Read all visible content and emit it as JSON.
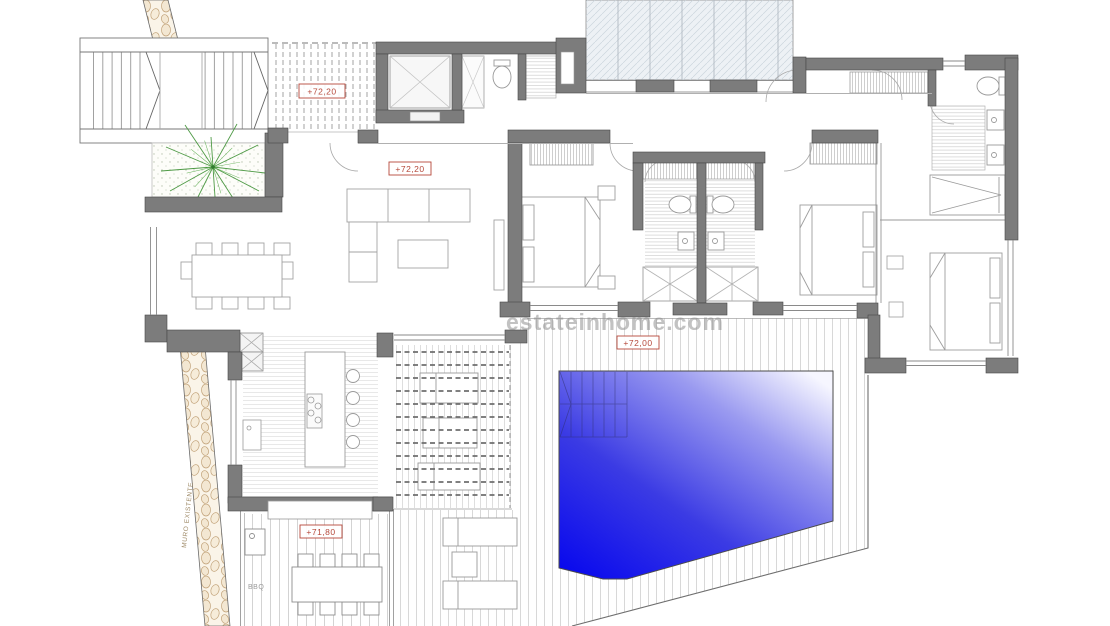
{
  "page": {
    "type": "architectural-floor-plan",
    "description": "Villa main floor plan with pool and deck"
  },
  "labels": {
    "upper_deck_level": "+72,20",
    "living_level": "+72,20",
    "pool_deck_level": "+72,00",
    "terrace_level": "+71,80",
    "elevator": "ASCENSOR",
    "existing_wall": "MURO EXISTENTE",
    "bbq": "BBQ",
    "watermark": "estateinhome.com"
  },
  "colors": {
    "wall": "#7c7c7c",
    "label_red": "#b5483a",
    "pool_deep": "#0808f2",
    "pool_shallow": "#fafaff",
    "plant_green": "#4e9a45",
    "pebble_tan": "#c2a37a",
    "glazing_blue": "#edf1f5"
  }
}
